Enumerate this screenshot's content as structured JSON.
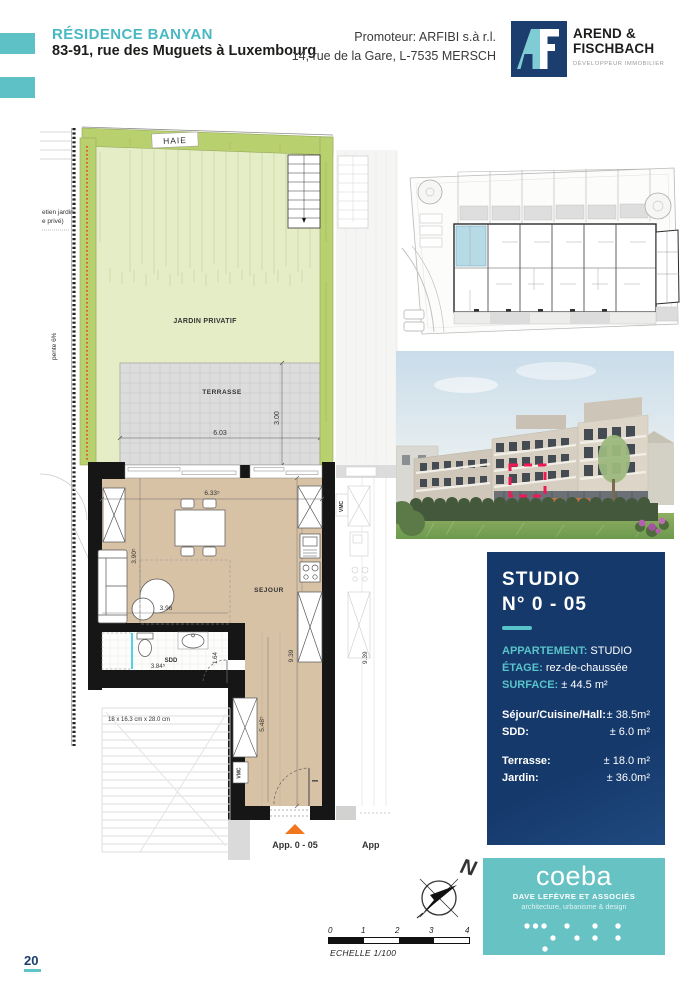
{
  "header": {
    "project_title": "RÉSIDENCE BANYAN",
    "project_address": "83-91, rue des Muguets à Luxembourg",
    "promoter_line1": "Promoteur: ARFIBI s.à r.l.",
    "promoter_line2": "14, rue de la Gare, L-7535 MERSCH",
    "developer": {
      "name_line1": "AREND &",
      "name_line2": "FISCHBACH",
      "tagline": "DÉVELOPPEUR IMMOBILIER"
    }
  },
  "plan": {
    "labels": {
      "hedge": "HAIE",
      "garden": "JARDIN PRIVATIF",
      "terrace": "TERRASSE",
      "living": "SEJOUR",
      "shower_room": "SDD",
      "vent": "VMC",
      "vent_neighbor": "VMC",
      "apartment_marker": "App. 0 - 05",
      "neighbor_marker": "App",
      "boundary_note_line1": "etien jardin",
      "boundary_note_line2": "e privé)",
      "slope_note": "pente 6%",
      "stair_note": "18 x 16.3 cm x 28.0 cm"
    },
    "dimensions": {
      "terrace_width": "6.03",
      "terrace_depth": "3.00",
      "living_width": "6.33⁵",
      "living_left_depth": "3.90⁵",
      "living_sub_width": "3.96",
      "sdd_width": "3.84⁵",
      "sdd_depth": "1.64",
      "hall_depth": "5.48⁵",
      "unit_depth": "9.39",
      "neighbor_depth": "9.39"
    }
  },
  "unit_card": {
    "title_line1": "STUDIO",
    "title_line2": "N° 0 - 05",
    "specs": [
      {
        "label": "APPARTEMENT:",
        "value": "STUDIO"
      },
      {
        "label": "ÉTAGE:",
        "value": "rez-de-chaussée"
      },
      {
        "label": "SURFACE:",
        "value": "± 44.5 m²"
      }
    ],
    "areas_interior": [
      {
        "label": "Séjour/Cuisine/Hall:",
        "value": "± 38.5m²"
      },
      {
        "label": "SDD:",
        "value": "± 6.0 m²"
      }
    ],
    "areas_exterior": [
      {
        "label": "Terrasse:",
        "value": "± 18.0 m²"
      },
      {
        "label": "Jardin:",
        "value": "± 36.0m²"
      }
    ]
  },
  "compass": {
    "north_label": "N"
  },
  "scale_bar": {
    "ticks": [
      "0",
      "1",
      "2",
      "3",
      "4"
    ],
    "caption": "ECHELLE 1/100"
  },
  "architect": {
    "name": "coeba",
    "subtitle": "DAVE LEFÈVRE ET ASSOCIÉS",
    "tagline": "architecture, urbanisme & design"
  },
  "colors": {
    "accent_teal": "#5ec1c6",
    "navy": "#16396b",
    "hedge_green": "#b9d06f",
    "garden_green": "#e5edc6",
    "terrace_gray": "#dcdcdc",
    "floor_beige": "#d8c2a6",
    "highlight_blue": "#b7dbe6",
    "marker_orange": "#f2761b",
    "photo_highlight": "#ee1a58",
    "wall_black": "#161616",
    "boundary_red": "#e2451c"
  }
}
